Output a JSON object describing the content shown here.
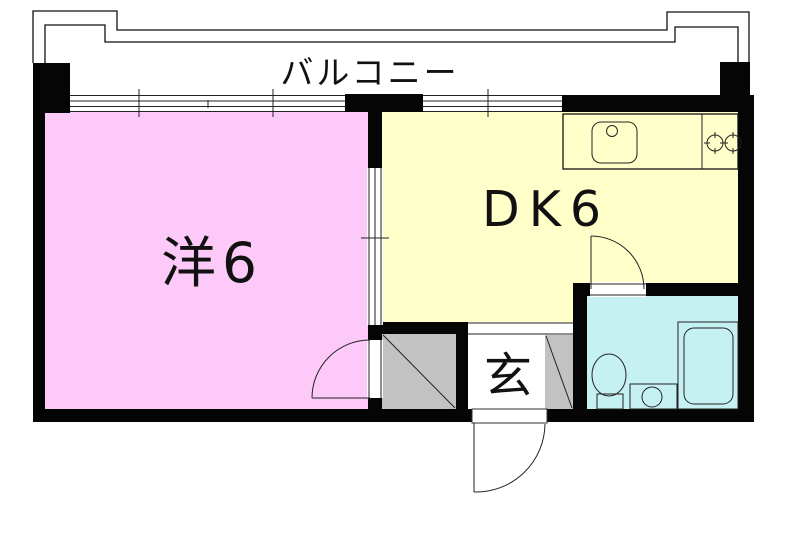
{
  "floorplan": {
    "balcony": {
      "label": "バルコニー"
    },
    "rooms": {
      "western": {
        "label": "洋6",
        "color": "#FCC9F8"
      },
      "dining_kitchen": {
        "label": "DK6",
        "color": "#FFFFC9"
      },
      "entrance": {
        "label": "玄",
        "color": "#FFFFFF"
      },
      "bathroom": {
        "color": "#C6F1F3"
      },
      "closet": {
        "color": "#C2C2C2"
      }
    },
    "wall_color": "#050505",
    "fixtures": [
      "kitchen-sink",
      "faucet",
      "stove-burners",
      "toilet",
      "washbasin",
      "bathtub",
      "entry-door",
      "hinged-door",
      "sliding-door",
      "window"
    ]
  }
}
